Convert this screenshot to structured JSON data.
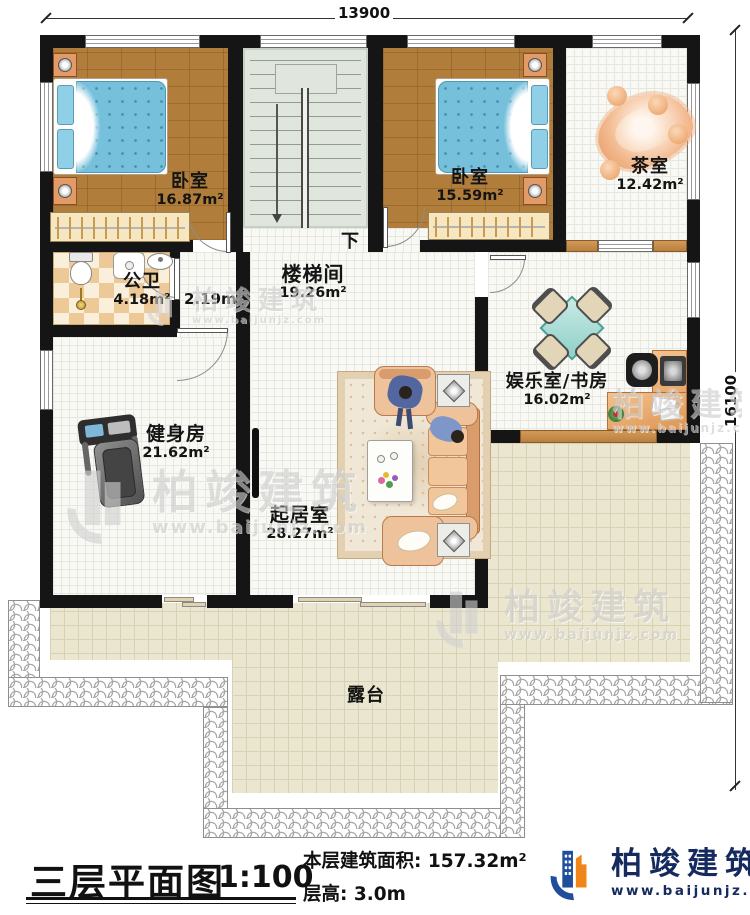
{
  "dims": {
    "top": "13900",
    "right": "16100"
  },
  "rooms": {
    "bedroom1": {
      "name": "卧室",
      "area": "16.87m²"
    },
    "bedroom2": {
      "name": "卧室",
      "area": "15.59m²"
    },
    "tea_room": {
      "name": "茶室",
      "area": "12.42m²"
    },
    "bathroom": {
      "name": "公卫",
      "area": "4.18m²"
    },
    "closet": {
      "area": "2.19m²"
    },
    "stair_hall": {
      "name": "楼梯间",
      "area": "19.26m²",
      "direction": "下"
    },
    "gym": {
      "name": "健身房",
      "area": "21.62m²"
    },
    "living": {
      "name": "起居室",
      "area": "28.27m²"
    },
    "study": {
      "name": "娱乐室/书房",
      "area": "16.02m²"
    },
    "terrace": {
      "name": "露台"
    }
  },
  "title_block": {
    "title": "三层平面图",
    "scale": "1:100",
    "floor_area": "本层建筑面积: 157.32m²",
    "floor_height": "层高: 3.0m"
  },
  "brand": {
    "name": "柏竣建筑",
    "website": "www.baijunjz.com"
  },
  "colors": {
    "wall": "#151515",
    "wood_floor": "#a97430",
    "bed_blue": "#76c0dc",
    "furniture_tan": "#eec39b",
    "table_teal": "#a8dcd8",
    "brand_blue": "#1f4e9c",
    "brand_orange": "#f08519",
    "terrace": "#ebe6cf"
  }
}
